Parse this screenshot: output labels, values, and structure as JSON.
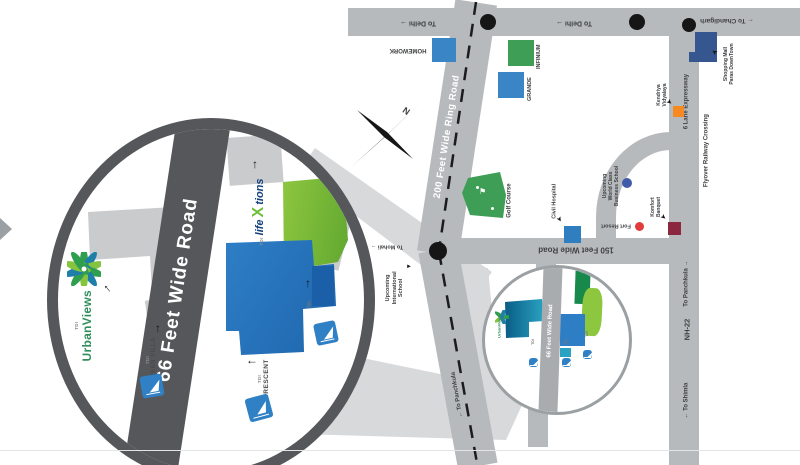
{
  "title": "Project location map with 66 Feet Wide Road magnifier",
  "colors": {
    "road_gray": "#b7babc",
    "dark_gray": "#55575a",
    "beam_gray": "#d8d9db",
    "plot_blue": "#2e7ec6",
    "plot_lime": "#8dc63f",
    "plot_green": "#3f9e55",
    "plot_teal": "#2aa3c2",
    "kv_orange": "#f6891f",
    "banquet_maroon": "#8c2740",
    "resort_red": "#e23b3b",
    "mall_navy": "#35568f",
    "school_blue": "#3f5ba9"
  },
  "map": {
    "roads": {
      "ring_road": "200 Feet Wide Ring Road",
      "road_150": "150 Feet Wide Road",
      "nh22": "NH-22",
      "expressway": "6 Lane Expressway"
    },
    "directions": {
      "to_delhi_west": "To Delhi →",
      "to_delhi_east": "To Delhi →",
      "to_chandigarh": "← To Chandigarh",
      "to_mohali": "To Mohali →",
      "to_panchkula_nh": "To Panchkula →",
      "to_shimla": "← To Shimla",
      "to_panchkula_ring": "← To Panchkula"
    },
    "places": {
      "homework": "HOMEWORK",
      "infinium": "INFINIUM",
      "grande": "GRANDE",
      "shopping_mall": "Shopping Mall\nParas DownTown",
      "kendriya_vidyalaya": "Kendriya\nVidyalaya",
      "flyover_crossing": "Flyover Railway Crossing",
      "business_school": "Upcoming\nWorld Class\nBusiness School",
      "fort_resort": "Fort Resort",
      "komfort_banquet": "Komfort\nBanquet",
      "civil_hospital": "Civil Hospital",
      "golf_course": "Golf Course",
      "intl_school": "Upcoming\nInternational\nSchool"
    },
    "compass_n": "N"
  },
  "magnifier": {
    "road_66": "66 Feet Wide Road",
    "urbanviews": {
      "prefix": "TDI",
      "name": "UrbanViews"
    },
    "lifextions": {
      "prefix": "TDI",
      "pre": "life",
      "x": "X",
      "post": "tions"
    },
    "green_villa": {
      "prefix": "TDI",
      "name": "GREEN VILLA"
    },
    "crescent": {
      "prefix": "TDI",
      "name": "CRESCENT"
    },
    "tdi_plot_caption": "TDI"
  },
  "inset": {
    "road_66": "66 Feet Wide Road",
    "urbanviews": "UrbanViews",
    "tdi": "TDI"
  }
}
